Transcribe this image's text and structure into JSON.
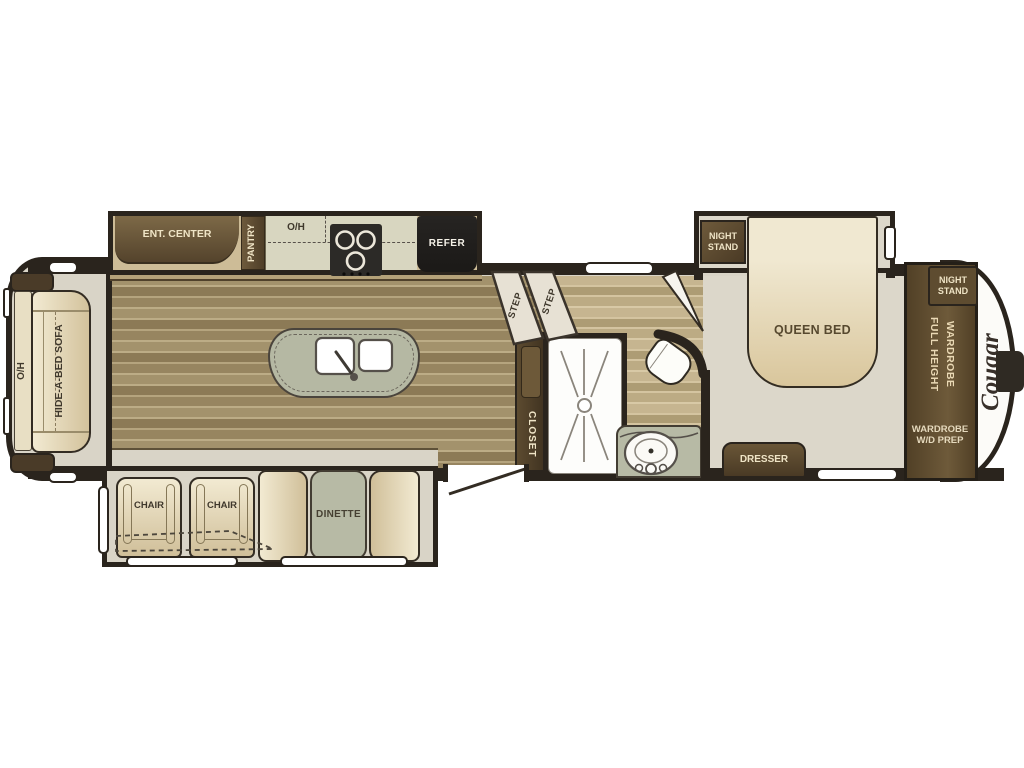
{
  "plan": {
    "brand_logo": "Cougar",
    "kitchen": {
      "ent_center": "ENT. CENTER",
      "pantry": "PANTRY",
      "overhead": "O/H",
      "refer": "REFER"
    },
    "living": {
      "overhead": "O/H",
      "sofa": "HIDE-A-BED SOFA",
      "chair_left": "CHAIR",
      "chair_right": "CHAIR",
      "dinette": "DINETTE"
    },
    "hall": {
      "step_upper": "STEP",
      "step_lower": "STEP",
      "closet": "CLOSET"
    },
    "bedroom": {
      "slide_night_stand": "NIGHT STAND",
      "queen_bed": "QUEEN BED",
      "dresser": "DRESSER",
      "front_night_stand": "NIGHT STAND",
      "full_height_wardrobe": "FULL HEIGHT WARDROBE",
      "wardrobe_wd_prep": "WARDROBE W/D PREP"
    }
  },
  "colors": {
    "wall": "#2a241d",
    "wood_floor": "#9c8a64",
    "bath_floor": "#c3b28c",
    "carpet": "#d9d4c7",
    "cream_furniture": "#efe7cf",
    "dark_cabinet": "#5d4b31",
    "sage": "#b7baa5",
    "appliance_black": "#23211f",
    "cap_white": "#fcfbf8"
  }
}
